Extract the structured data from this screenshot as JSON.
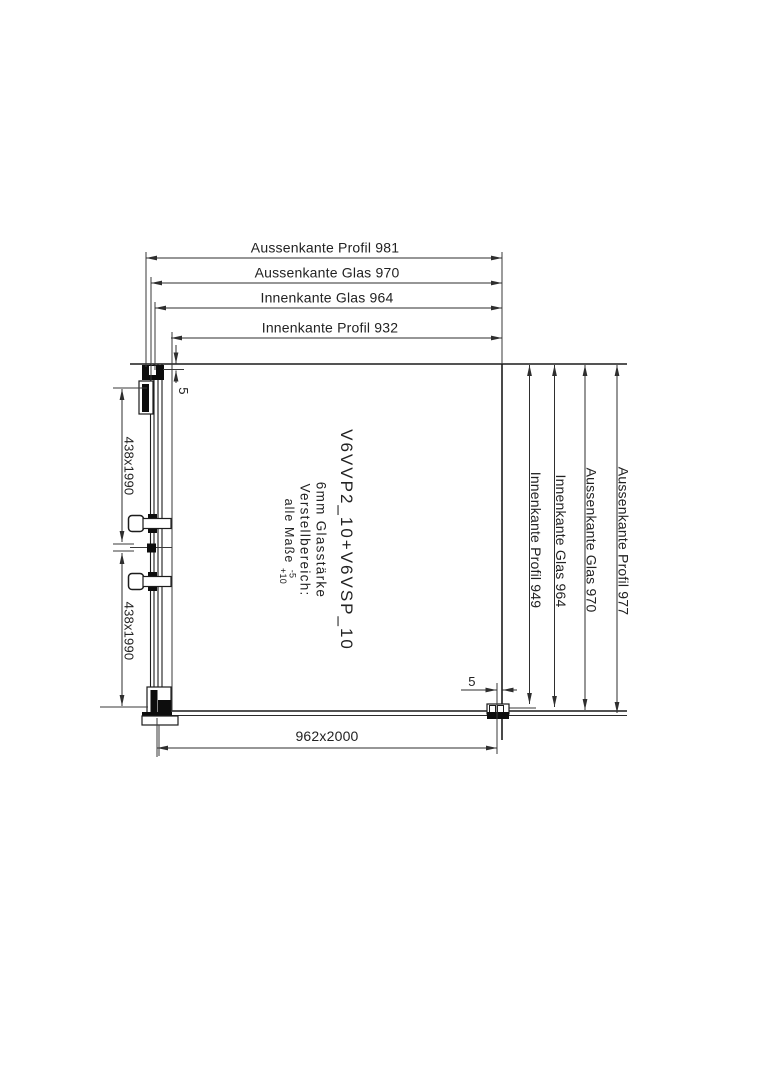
{
  "dims": {
    "top": [
      "Aussenkante Profil 981",
      "Aussenkante Glas 970",
      "Innenkante Glas 964",
      "Innenkante Profil 932"
    ],
    "right": [
      "Innenkante Profil 949",
      "Innenkante Glas 964",
      "Aussenkante Glas 970",
      "Aussenkante Profil 977"
    ],
    "left": [
      "438x1990",
      "438x1990"
    ],
    "bottom": "962x2000",
    "gap_top_left": "5",
    "gap_bottom_right": "5"
  },
  "annotation": {
    "model_code": "V6VVP2_10+V6VSP_10",
    "glass_thickness": "6mm Glasstärke",
    "adjustment_label": "Verstellbereich:",
    "adjustment_scope": "alle Maße",
    "adjustment_minus": "-5",
    "adjustment_plus": "+10"
  },
  "colors": {
    "line": "#2e2e2e",
    "profile": "#111111",
    "text": "#222222",
    "background": "#ffffff"
  }
}
